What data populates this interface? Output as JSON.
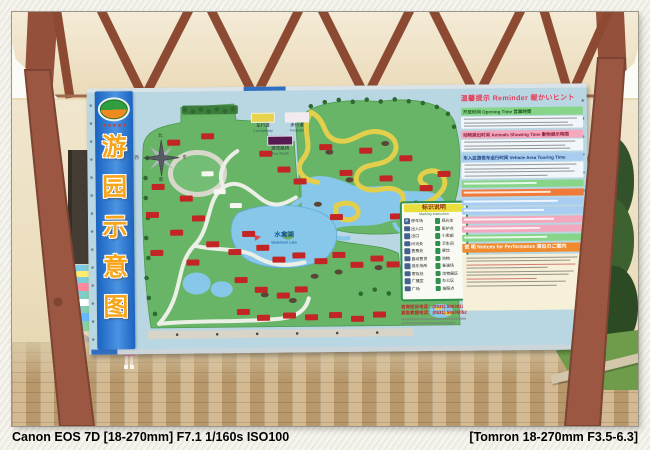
{
  "photo_caption": {
    "left": "Canon EOS 7D [18-270mm] F7.1 1/160s ISO100",
    "right": "[Tomron 18-270mm F3.5-6.3]"
  },
  "board": {
    "title_chars": [
      "游",
      "园",
      "示",
      "意",
      "图"
    ],
    "compass": {
      "north": "北",
      "south": "南",
      "east": "东",
      "west": "西"
    },
    "road_legend": {
      "carriageway": "车行道",
      "carriageway_en": "Carriageway",
      "footpath": "步行道",
      "footpath_en": "Footpath",
      "tour_route": "游览路线",
      "tour_route_en": "Tour Route"
    },
    "map": {
      "lake_name": "水禽湖",
      "lake_name_en": "Waterfowl Lake"
    },
    "marking_legend": {
      "title": "标识说明",
      "subtitle": "Marking Instruction",
      "p_icon": "P",
      "items_left": [
        "停车场",
        "出入口",
        "出口",
        "问讯处",
        "售票处",
        "自动售货",
        "游乐场所",
        "寄存处",
        "广播室",
        "广场"
      ],
      "items_right": [
        "观光车",
        "医护点",
        "小卖部",
        "卫生间",
        "餐饮",
        "购物",
        "表演场",
        "动物展区",
        "办公区",
        "拍照点"
      ],
      "phone1": "咨询投诉电话：(0531) 58636120",
      "phone2": "紧急救援电话：(0531) 58636052"
    },
    "reminder": {
      "title": "温馨提示 Reminder 暖かいヒント",
      "sections": [
        {
          "title": "开放时间 Opening Time 営業時間"
        },
        {
          "title": "动物展出时间 Animals Showing Time 動物展示時間"
        },
        {
          "title": "车入区游览车运行时间 Vehicle Area Touring Time"
        }
      ],
      "notice_title": "说 明 Notices for Performance 演出のご案内"
    }
  },
  "colors": {
    "banner_blue": "#1a63c0",
    "banner_char_orange": "#f7a61b",
    "board_blue": "#b9d6e3",
    "map_green": "#68b568",
    "water_blue": "#86c7ea",
    "vehicle_road_yellow": "#e3cf4b",
    "label_red": "#c32424",
    "band_green": "#86d589",
    "band_pink": "#f3a8bd",
    "band_blue": "#a9cdf1",
    "band_orange": "#ef7a3a",
    "notice_orange": "#ef8b2e",
    "post_brown": "#9b5742"
  }
}
